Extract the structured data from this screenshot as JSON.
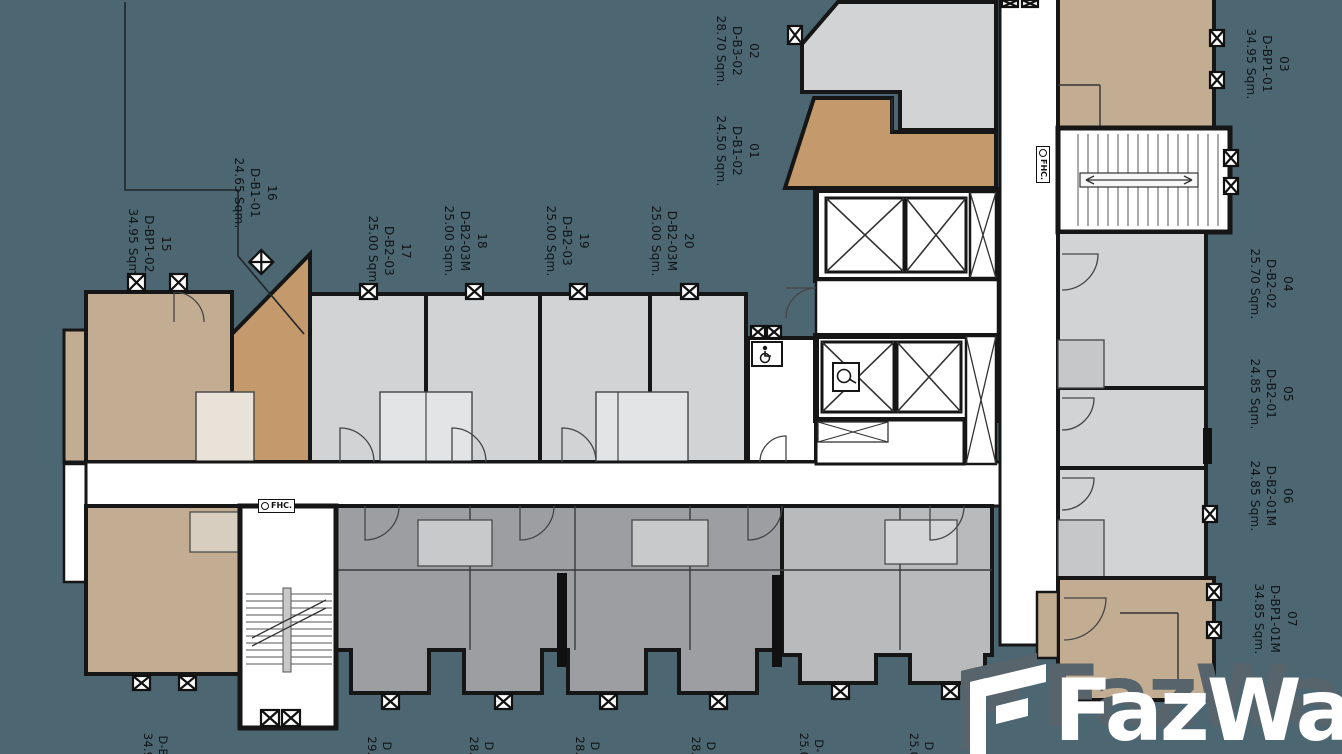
{
  "page": {
    "type": "condo-floor-plan"
  },
  "colors": {
    "background": "#4c6672",
    "unit_tan": "#c3ad92",
    "unit_orange": "#c49a6c",
    "unit_lightgray": "#d2d3d5",
    "unit_midgray": "#9d9ea1",
    "unit_gray2": "#b9babc",
    "wall": "#161616",
    "corridor": "#ffffff",
    "watermark_shadow": "#58646b"
  },
  "watermark": {
    "brand": "FazWaz"
  },
  "fhc": {
    "label": "FHC."
  },
  "unit_labels": [
    {
      "number": "01",
      "code": "D-B1-02",
      "area": "24.50 Sqm."
    },
    {
      "number": "02",
      "code": "D-B3-02",
      "area": "28.70 Sqm."
    },
    {
      "number": "03",
      "code": "D-BP1-01",
      "area": "34.95 Sqm."
    },
    {
      "number": "04",
      "code": "D-B2-02",
      "area": "25.70 Sqm."
    },
    {
      "number": "05",
      "code": "D-B2-01",
      "area": "24.85 Sqm."
    },
    {
      "number": "06",
      "code": "D-B2-01M",
      "area": "24.85 Sqm."
    },
    {
      "number": "07",
      "code": "D-BP1-01M",
      "area": "34.85 Sqm."
    },
    {
      "number": "15",
      "code": "D-BP1-02",
      "area": "34.95 Sqm."
    },
    {
      "number": "16",
      "code": "D-B1-01",
      "area": "24.65 Sqm."
    },
    {
      "number": "17",
      "code": "D-B2-03",
      "area": "25.00 Sqm."
    },
    {
      "number": "18",
      "code": "D-B2-03M",
      "area": "25.00 Sqm."
    },
    {
      "number": "19",
      "code": "D-B2-03",
      "area": "25.00 Sqm."
    },
    {
      "number": "20",
      "code": "D-B2-03M",
      "area": "25.00 Sqm."
    }
  ],
  "bottom_labels": [
    {
      "code": "D-B",
      "area": "34.9"
    },
    {
      "code": "D",
      "area": "29."
    },
    {
      "code": "D",
      "area": "28."
    },
    {
      "code": "D",
      "area": "28."
    },
    {
      "code": "D",
      "area": "28."
    },
    {
      "code": "D-",
      "area": "25.0"
    },
    {
      "code": "D",
      "area": "25.0"
    }
  ]
}
